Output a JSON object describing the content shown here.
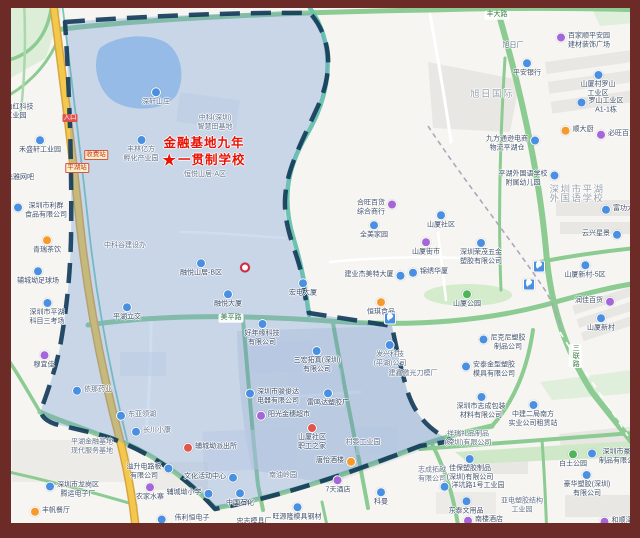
{
  "map": {
    "frame_color": "#6D2B27",
    "zone_fill": "#6F9BD6",
    "zone_border": "#123A58",
    "highway_color": "#F2C94C",
    "road_green": "#8CCB92",
    "water_color": "#A9CBEE",
    "school_marker": {
      "star": "★",
      "line1": "金融基地九年",
      "line2": "一贯制学校",
      "color": "#EA1205"
    },
    "labels": [
      {
        "x": 16,
        "y": 112,
        "lines": [
          "日山红科技",
          "工业园"
        ],
        "icon": "blue",
        "iconPos": "left"
      },
      {
        "x": 40,
        "y": 145,
        "lines": [
          "禾盛轩工业园"
        ],
        "icon": "blue",
        "iconPos": "top"
      },
      {
        "x": 20,
        "y": 178,
        "lines": [
          "飞雅网吧"
        ]
      },
      {
        "x": 46,
        "y": 211,
        "lines": [
          "深圳市利群",
          "食品有限公司"
        ],
        "icon": "blue",
        "iconPos": "left"
      },
      {
        "x": 47,
        "y": 245,
        "lines": [
          "青瑞茶饮"
        ],
        "icon": "orange",
        "iconPos": "top"
      },
      {
        "x": 38,
        "y": 276,
        "lines": [
          "辅城坳足球场"
        ],
        "icon": "blue",
        "iconPos": "top"
      },
      {
        "x": 47,
        "y": 312,
        "lines": [
          "深圳市平湖",
          "科目三考场"
        ],
        "icon": "blue",
        "iconPos": "top"
      },
      {
        "x": 44,
        "y": 360,
        "lines": [
          "穆宜佳"
        ],
        "icon": "purple",
        "iconPos": "top"
      },
      {
        "x": 156,
        "y": 97,
        "lines": [
          "深轩山庄"
        ],
        "icon": "blue",
        "iconPos": "top",
        "muted": true
      },
      {
        "x": 215,
        "y": 123,
        "lines": [
          "中科(深圳)",
          "智慧田基地"
        ],
        "muted": true
      },
      {
        "x": 141,
        "y": 149,
        "lines": [
          "丰林亿方",
          "孵化产业园"
        ],
        "icon": "blue",
        "iconPos": "top",
        "muted": true
      },
      {
        "x": 205,
        "y": 175,
        "lines": [
          "恒悦山居-A区"
        ],
        "muted": true
      },
      {
        "x": 125,
        "y": 246,
        "lines": [
          "中科谷建设办"
        ],
        "muted": true
      },
      {
        "x": 201,
        "y": 268,
        "lines": [
          "融悦山居-B区"
        ],
        "icon": "blue",
        "iconPos": "top"
      },
      {
        "x": 228,
        "y": 299,
        "lines": [
          "融悦大厦"
        ],
        "icon": "blue",
        "iconPos": "top"
      },
      {
        "x": 127,
        "y": 312,
        "lines": [
          "平湖立交"
        ],
        "icon": "blue",
        "iconPos": "top"
      },
      {
        "x": 262,
        "y": 333,
        "lines": [
          "好年缘科技",
          "有限公司"
        ],
        "icon": "blue",
        "iconPos": "top"
      },
      {
        "x": 303,
        "y": 288,
        "lines": [
          "宏电大厦"
        ],
        "icon": "blue",
        "iconPos": "top"
      },
      {
        "x": 98,
        "y": 390,
        "lines": [
          "依那药业"
        ],
        "icon": "blue",
        "iconPos": "left",
        "muted": true
      },
      {
        "x": 142,
        "y": 415,
        "lines": [
          "东亚领湖"
        ],
        "icon": "blue",
        "iconPos": "left",
        "muted": true
      },
      {
        "x": 157,
        "y": 431,
        "lines": [
          "长川小康"
        ],
        "icon": "blue",
        "iconPos": "left",
        "muted": true
      },
      {
        "x": 92,
        "y": 447,
        "lines": [
          "平湖金融基地",
          "现代服务基地"
        ],
        "muted": true
      },
      {
        "x": 317,
        "y": 360,
        "lines": [
          "三宏拓真(深圳)",
          "有限公司"
        ],
        "icon": "blue",
        "iconPos": "top"
      },
      {
        "x": 278,
        "y": 397,
        "lines": [
          "深圳市骏俊达",
          "电器有限公司"
        ],
        "icon": "blue",
        "iconPos": "left"
      },
      {
        "x": 328,
        "y": 398,
        "lines": [
          "雷鸣达塑胶厂"
        ],
        "icon": "blue",
        "iconPos": "top"
      },
      {
        "x": 289,
        "y": 415,
        "lines": [
          "阳光金穗超市"
        ],
        "icon": "purple",
        "iconPos": "left"
      },
      {
        "x": 312,
        "y": 437,
        "lines": [
          "山厦社区",
          "职工之家"
        ],
        "icon": "red",
        "iconPos": "top"
      },
      {
        "x": 363,
        "y": 443,
        "lines": [
          "村委工业园"
        ],
        "muted": true
      },
      {
        "x": 330,
        "y": 461,
        "lines": [
          "唐怡酒楼"
        ],
        "icon": "orange",
        "iconPos": "right"
      },
      {
        "x": 283,
        "y": 476,
        "lines": [
          "南油岭园"
        ],
        "muted": true
      },
      {
        "x": 338,
        "y": 485,
        "lines": [
          "7天酒店"
        ],
        "icon": "purple",
        "iconPos": "top"
      },
      {
        "x": 390,
        "y": 354,
        "lines": [
          "发兴科技",
          "(平湖)公司"
        ],
        "icon": "blue",
        "iconPos": "top",
        "muted": true
      },
      {
        "x": 413,
        "y": 374,
        "lines": [
          "建鑫激光刀模厂"
        ],
        "muted": true
      },
      {
        "x": 216,
        "y": 447,
        "lines": [
          "辅城坳派出所"
        ],
        "icon": "red",
        "iconPos": "left"
      },
      {
        "x": 78,
        "y": 490,
        "lines": [
          "深圳市龙岗区",
          "腾运电子厂"
        ],
        "icon": "blue",
        "iconPos": "left"
      },
      {
        "x": 56,
        "y": 511,
        "lines": [
          "丰帆餐厅"
        ],
        "icon": "orange",
        "iconPos": "left"
      },
      {
        "x": 144,
        "y": 472,
        "lines": [
          "溢升电路板",
          "有限公司"
        ],
        "icon": "blue",
        "iconPos": "right"
      },
      {
        "x": 150,
        "y": 492,
        "lines": [
          "农家水寨"
        ],
        "icon": "purple",
        "iconPos": "top"
      },
      {
        "x": 184,
        "y": 493,
        "lines": [
          "辅城坳小学"
        ],
        "icon": "blue",
        "iconPos": "right"
      },
      {
        "x": 205,
        "y": 477,
        "lines": [
          "文化活动中心"
        ],
        "icon": "blue",
        "iconPos": "right"
      },
      {
        "x": 192,
        "y": 523,
        "lines": [
          "伟利恒电子",
          "(深圳)有限公司"
        ],
        "icon": "blue",
        "iconPos": "left"
      },
      {
        "x": 240,
        "y": 498,
        "lines": [
          "中国石化"
        ],
        "icon": "blue",
        "iconPos": "top"
      },
      {
        "x": 254,
        "y": 522,
        "lines": [
          "忠志模具厂"
        ]
      },
      {
        "x": 297,
        "y": 512,
        "lines": [
          "旺源隆模具钢材"
        ],
        "icon": "blue",
        "iconPos": "top"
      },
      {
        "x": 381,
        "y": 497,
        "lines": [
          "科曼"
        ],
        "icon": "blue",
        "iconPos": "top"
      },
      {
        "x": 513,
        "y": 46,
        "lines": [
          "旭日厂"
        ],
        "muted": true
      },
      {
        "x": 527,
        "y": 68,
        "lines": [
          "平安银行"
        ],
        "icon": "blue",
        "iconPos": "top"
      },
      {
        "x": 589,
        "y": 41,
        "lines": [
          "百家顺平安园",
          "建材装饰广场"
        ],
        "icon": "purple",
        "iconPos": "left"
      },
      {
        "x": 492,
        "y": 95,
        "lines": [
          "旭日国际"
        ],
        "kind": "area"
      },
      {
        "x": 598,
        "y": 84,
        "lines": [
          "山厦村罗山",
          "工业区"
        ],
        "icon": "blue",
        "iconPos": "top"
      },
      {
        "x": 606,
        "y": 106,
        "lines": [
          "罗山工业区",
          "A1-1栋"
        ],
        "icon": "blue",
        "iconPos": "left"
      },
      {
        "x": 583,
        "y": 130,
        "lines": [
          "顺大厨"
        ],
        "icon": "orange",
        "iconPos": "left"
      },
      {
        "x": 622,
        "y": 134,
        "lines": [
          "必旺百货"
        ],
        "icon": "purple",
        "iconPos": "left"
      },
      {
        "x": 507,
        "y": 144,
        "lines": [
          "九方通逊电商",
          "物流平湖仓"
        ],
        "icon": "blue",
        "iconPos": "right"
      },
      {
        "x": 523,
        "y": 179,
        "lines": [
          "平湖外国语学校",
          "附属幼儿园"
        ],
        "icon": "blue",
        "iconPos": "right"
      },
      {
        "x": 577,
        "y": 195,
        "lines": [
          "深圳市平湖",
          "外国语学校"
        ],
        "kind": "area"
      },
      {
        "x": 441,
        "y": 220,
        "lines": [
          "山厦社区"
        ],
        "icon": "blue",
        "iconPos": "top"
      },
      {
        "x": 426,
        "y": 247,
        "lines": [
          "山厦街市"
        ],
        "icon": "purple",
        "iconPos": "top"
      },
      {
        "x": 481,
        "y": 252,
        "lines": [
          "深圳荣茂五金",
          "塑胶有限公司"
        ],
        "icon": "blue",
        "iconPos": "top"
      },
      {
        "x": 371,
        "y": 208,
        "lines": [
          "合旺百货",
          "综合商行"
        ],
        "icon": "purple",
        "iconPos": "right"
      },
      {
        "x": 374,
        "y": 230,
        "lines": [
          "全美家园"
        ],
        "icon": "blue",
        "iconPos": "top"
      },
      {
        "x": 369,
        "y": 275,
        "lines": [
          "建业杰美特大厦"
        ],
        "icon": "blue",
        "iconPos": "right"
      },
      {
        "x": 434,
        "y": 272,
        "lines": [
          "锦绣华厦"
        ],
        "icon": "blue",
        "iconPos": "left"
      },
      {
        "x": 381,
        "y": 307,
        "lines": [
          "恒琪食品"
        ],
        "icon": "orange",
        "iconPos": "top"
      },
      {
        "x": 467,
        "y": 299,
        "lines": [
          "山厦公园"
        ],
        "icon": "green",
        "iconPos": "top"
      },
      {
        "x": 596,
        "y": 234,
        "lines": [
          "云兴星景"
        ],
        "icon": "blue",
        "iconPos": "right"
      },
      {
        "x": 585,
        "y": 270,
        "lines": [
          "山厦新村-5区"
        ],
        "icon": "blue",
        "iconPos": "top"
      },
      {
        "x": 589,
        "y": 301,
        "lines": [
          "润佳百货"
        ],
        "icon": "purple",
        "iconPos": "right"
      },
      {
        "x": 601,
        "y": 323,
        "lines": [
          "山厦新村"
        ],
        "icon": "blue",
        "iconPos": "top"
      },
      {
        "x": 508,
        "y": 343,
        "lines": [
          "尼克尼塑胶",
          "制品公司"
        ],
        "icon": "blue",
        "iconPos": "left"
      },
      {
        "x": 494,
        "y": 370,
        "lines": [
          "安泰金型塑胶",
          "模具有限公司"
        ],
        "icon": "blue",
        "iconPos": "left"
      },
      {
        "x": 481,
        "y": 406,
        "lines": [
          "深圳市志成包装",
          "材料有限公司"
        ],
        "icon": "blue",
        "iconPos": "top"
      },
      {
        "x": 533,
        "y": 414,
        "lines": [
          "中建二局南方",
          "实业公司租赁站"
        ],
        "icon": "blue",
        "iconPos": "top"
      },
      {
        "x": 627,
        "y": 209,
        "lines": [
          "富功大厦"
        ],
        "icon": "blue",
        "iconPos": "left"
      },
      {
        "x": 468,
        "y": 439,
        "lines": [
          "祥瑞礼品制品",
          "(深圳)有限公司"
        ],
        "muted": true
      },
      {
        "x": 470,
        "y": 468,
        "lines": [
          "佳保塑胶制品",
          "(深圳)有限公司"
        ],
        "icon": "blue",
        "iconPos": "top"
      },
      {
        "x": 478,
        "y": 486,
        "lines": [
          "洋坑路1号工业园"
        ],
        "icon": "blue",
        "iconPos": "left"
      },
      {
        "x": 466,
        "y": 506,
        "lines": [
          "东泰文用品"
        ],
        "icon": "blue",
        "iconPos": "top"
      },
      {
        "x": 489,
        "y": 520,
        "lines": [
          "南楼酒店"
        ],
        "icon": "purple",
        "iconPos": "left"
      },
      {
        "x": 522,
        "y": 506,
        "lines": [
          "亚电塑胶结构",
          "工业园"
        ],
        "muted": true
      },
      {
        "x": 432,
        "y": 475,
        "lines": [
          "志成拓越",
          "有限公司"
        ],
        "muted": true
      },
      {
        "x": 573,
        "y": 459,
        "lines": [
          "白土公园"
        ],
        "icon": "green",
        "iconPos": "top"
      },
      {
        "x": 587,
        "y": 484,
        "lines": [
          "豪华塑胶(深圳)",
          "有限公司"
        ],
        "icon": "blue",
        "iconPos": "top"
      },
      {
        "x": 620,
        "y": 457,
        "lines": [
          "深圳市豪华",
          "制品有限公司"
        ],
        "icon": "blue",
        "iconPos": "left"
      },
      {
        "x": 622,
        "y": 521,
        "lines": [
          "和顺泽"
        ],
        "icon": "purple",
        "iconPos": "left"
      },
      {
        "x": 390,
        "y": 319,
        "icon": "parking",
        "glyph": "P"
      },
      {
        "x": 539,
        "y": 267,
        "icon": "parking",
        "glyph": "P"
      },
      {
        "x": 529,
        "y": 285,
        "icon": "parking",
        "glyph": "P"
      },
      {
        "x": 245,
        "y": 268,
        "icon": "metro"
      },
      {
        "x": 497,
        "y": 15,
        "lines": [
          "丰大路"
        ],
        "kind": "road"
      },
      {
        "x": 231,
        "y": 318,
        "lines": [
          "美平路"
        ],
        "kind": "road"
      },
      {
        "x": 575,
        "y": 356,
        "lines": [
          "三联路"
        ],
        "kind": "road",
        "dir": "v"
      },
      {
        "x": 96,
        "y": 155,
        "lines": [
          "收费站"
        ],
        "kind": "sign-plate"
      },
      {
        "x": 77,
        "y": 168,
        "lines": [
          "平湖站"
        ],
        "kind": "sign-plate"
      },
      {
        "x": 70,
        "y": 118,
        "lines": [
          "入口"
        ],
        "kind": "sign-red"
      }
    ]
  }
}
